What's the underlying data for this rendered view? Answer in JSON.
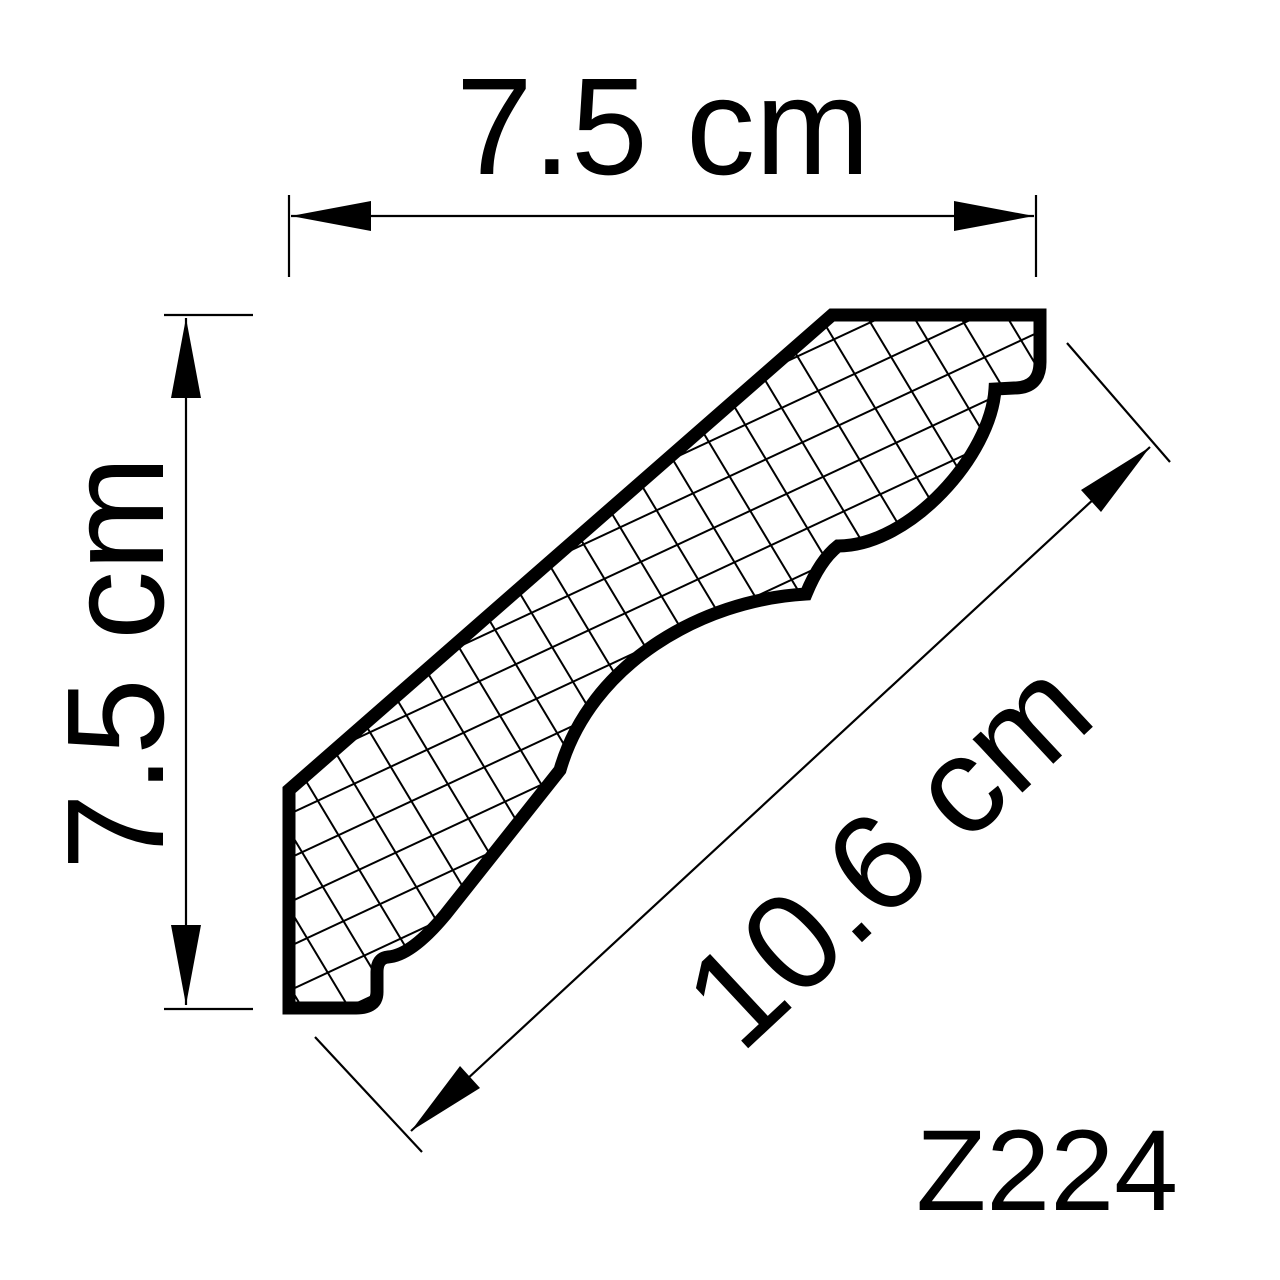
{
  "product": {
    "code": "Z224"
  },
  "dimensions": {
    "width": {
      "label": "7.5 cm",
      "value": 7.5,
      "unit": "cm"
    },
    "height": {
      "label": "7.5 cm",
      "value": 7.5,
      "unit": "cm"
    },
    "diagonal": {
      "label": "10.6 cm",
      "value": 10.6,
      "unit": "cm"
    }
  },
  "drawing": {
    "subject": "crown-molding-cross-section-profile",
    "fill_style": "crosshatch"
  },
  "colors": {
    "ink": "#000000",
    "background": "#ffffff"
  }
}
